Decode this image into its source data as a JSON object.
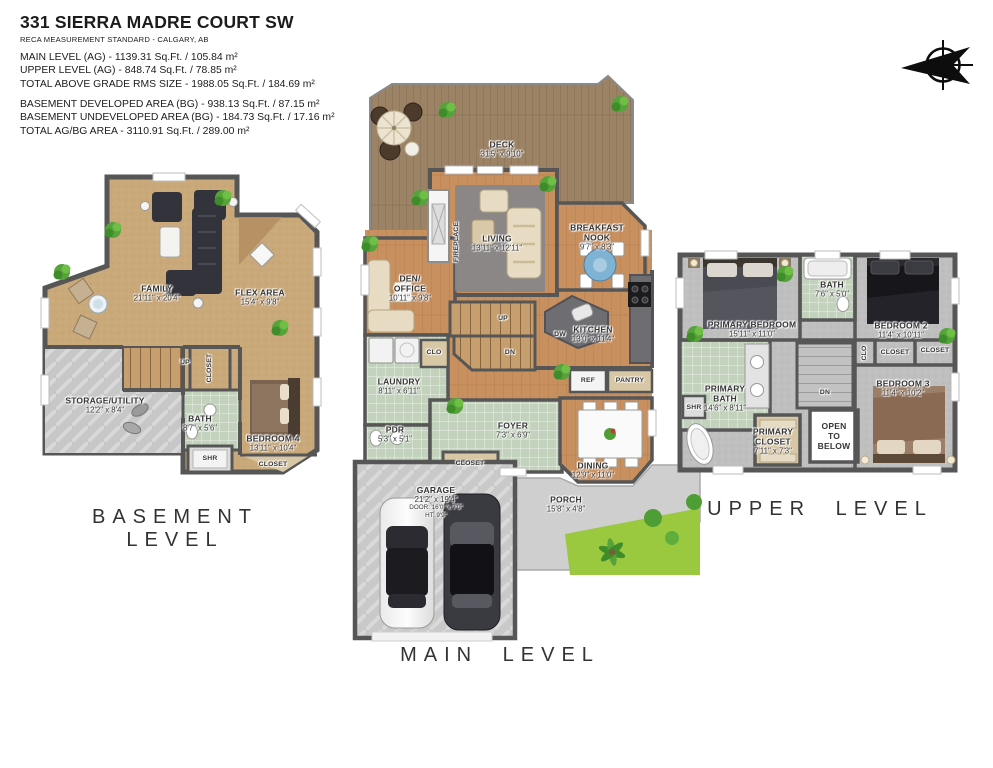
{
  "header": {
    "title": "331 SIERRA MADRE COURT SW",
    "standard": "RECA MEASUREMENT STANDARD - CALGARY, AB",
    "ag_lines": [
      "MAIN LEVEL (AG) - 1139.31 Sq.Ft. / 105.84 m²",
      "UPPER LEVEL (AG) - 848.74 Sq.Ft. / 78.85 m²",
      "TOTAL ABOVE GRADE RMS SIZE - 1988.05 Sq.Ft. / 184.69 m²"
    ],
    "bg_lines": [
      "BASEMENT DEVELOPED AREA (BG) - 938.13 Sq.Ft. / 87.15 m²",
      "BASEMENT UNDEVELOPED AREA (BG) - 184.73 Sq.Ft. / 17.16 m²",
      "TOTAL AG/BG AREA - 3110.91 Sq.Ft. / 289.00 m²"
    ]
  },
  "palette": {
    "wall": "#565656",
    "wood_floor": "#c8905f",
    "deck_wood": "#9c8366",
    "tile_green": "#c3d2bd",
    "carpet_tan": "#c9a87a",
    "carpet_gray": "#bfbfbf",
    "concrete": "#c9c9c9",
    "counter_gray": "#6e6e72",
    "grass_green": "#9ac93f",
    "plant_green": "#55a33a",
    "nook_table_blue": "#7fb3d4"
  },
  "levels": {
    "basement": {
      "caption": "BASEMENT LEVEL",
      "rooms": {
        "family": {
          "name": "FAMILY",
          "dims": "21'11\" x 20'4\""
        },
        "flex": {
          "name": "FLEX AREA",
          "dims": "15'4\" x 9'8\""
        },
        "storage": {
          "name": "STORAGE/UTILITY",
          "dims": "12'2\" x 8'4\""
        },
        "bath": {
          "name": "BATH",
          "dims": "8'7\" x 5'6\""
        },
        "bedroom4": {
          "name": "BEDROOM 4",
          "dims": "13'11\" x 10'4\""
        },
        "up": "UP",
        "closet_stairs": "CLOSET",
        "shr": "SHR",
        "closet_bed": "CLOSET"
      }
    },
    "main": {
      "caption": "MAIN LEVEL",
      "rooms": {
        "deck": {
          "name": "DECK",
          "dims": "31'5\" x 9'10\""
        },
        "living": {
          "name": "LIVING",
          "dims": "13'11\" x 12'11\""
        },
        "fireplace": "FIREPLACE",
        "nook": {
          "l1": "BREAKFAST",
          "l2": "NOOK",
          "dims": "9'7\" x 8'3\""
        },
        "den": {
          "l1": "DEN/",
          "l2": "OFFICE",
          "dims": "10'11\" x 9'8\""
        },
        "kitchen": {
          "name": "KITCHEN",
          "dims": "13'0\" x 11'4\""
        },
        "dw": "DW",
        "clo": "CLO",
        "up": "UP",
        "dn": "DN",
        "ref": "REF",
        "pantry": "PANTRY",
        "laundry": {
          "name": "LAUNDRY",
          "dims": "8'11\" x 6'11\""
        },
        "pdr": {
          "name": "PDR",
          "dims": "5'3\" x 5'1\""
        },
        "foyer": {
          "name": "FOYER",
          "dims": "7'3\" x 6'9\""
        },
        "closet": "CLOSET",
        "dining": {
          "name": "DINING",
          "dims": "12'9\" x 11'0\""
        },
        "garage": {
          "name": "GARAGE",
          "dims": "21'2\" x 19'4\"",
          "door": "DOOR: 16'0\" x 7'0\"",
          "ht": "HT: 9'9\""
        },
        "porch": {
          "name": "PORCH",
          "dims": "15'8\" x 4'8\""
        }
      }
    },
    "upper": {
      "caption": "UPPER LEVEL",
      "rooms": {
        "primary_bedroom": {
          "name": "PRIMARY BEDROOM",
          "dims": "15'11\" x 11'0\""
        },
        "bath": {
          "name": "BATH",
          "dims": "7'6\" x 5'0\""
        },
        "bedroom2": {
          "name": "BEDROOM 2",
          "dims": "11'4\" x 10'11\""
        },
        "clo": "CLO",
        "closet_a": "CLOSET",
        "closet_b": "CLOSET",
        "primary_bath": {
          "l1": "PRIMARY",
          "l2": "BATH",
          "dims": "14'6\" x 8'11\""
        },
        "shr": "SHR",
        "primary_closet": {
          "l1": "PRIMARY",
          "l2": "CLOSET",
          "dims": "7'11\" x 7'3\""
        },
        "open_below": {
          "l1": "OPEN",
          "l2": "TO",
          "l3": "BELOW"
        },
        "dn": "DN",
        "bedroom3": {
          "name": "BEDROOM 3",
          "dims": "11'4\" x 10'2\""
        }
      }
    }
  }
}
